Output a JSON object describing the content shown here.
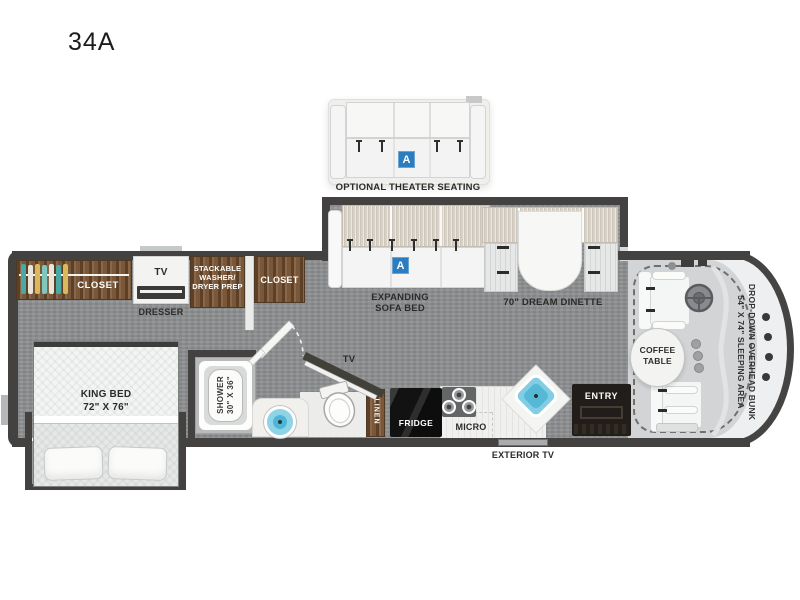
{
  "title": "34A",
  "theater": {
    "label": "OPTIONAL THEATER SEATING",
    "badge": "A"
  },
  "slideout": {
    "sofa": {
      "label": [
        "EXPANDING",
        "SOFA BED"
      ],
      "badge": "A"
    },
    "dinette": {
      "label": "70\" DREAM DINETTE"
    }
  },
  "storage": {
    "closet_rear": "CLOSET",
    "tv": "TV",
    "dresser": "DRESSER",
    "washer": [
      "STACKABLE",
      "WASHER/",
      "DRYER PREP"
    ],
    "closet_hall": "CLOSET",
    "linen": "LINEN"
  },
  "bedroom": {
    "bed_label": [
      "KING BED",
      "72\" X 76\""
    ]
  },
  "bath": {
    "shower_label": [
      "SHOWER",
      "30\" X 36\""
    ],
    "tv": "TV"
  },
  "kitchen": {
    "fridge": "FRIDGE",
    "micro": "MICRO"
  },
  "entry": {
    "label": "ENTRY"
  },
  "exterior": {
    "tv_label": "EXTERIOR TV"
  },
  "cab": {
    "coffee_table": [
      "COFFEE",
      "TABLE"
    ],
    "bunk_label": [
      "DROP-DOWN OVERHEAD BUNK",
      "54\" X 74\" SLEEPING AREA"
    ]
  },
  "colors": {
    "accent_blue": "#2c7dc0",
    "wood_brown": "#7a5738",
    "floor_gray": "#8e9092",
    "wall_dark": "#434241",
    "sink_blue": "#7fcce3"
  }
}
